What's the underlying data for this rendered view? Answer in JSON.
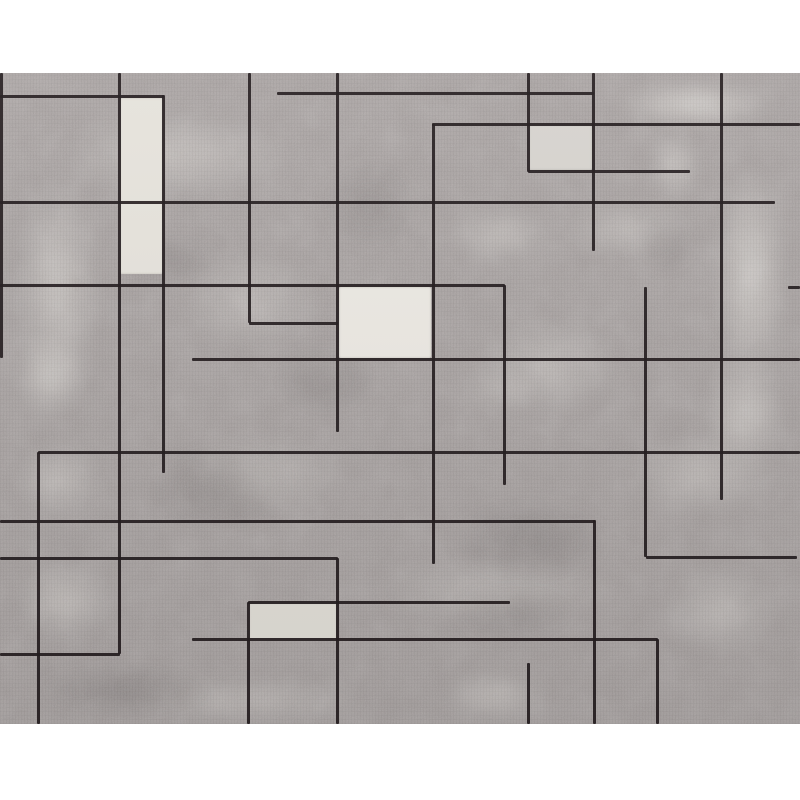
{
  "canvas": {
    "width": 800,
    "height": 800,
    "background": "#ffffff"
  },
  "rug": {
    "left": 0,
    "top": 73,
    "width": 800,
    "height": 651,
    "base_color": "#a39d9c",
    "light_mottle_color": "#e2dfda",
    "dark_mottle_color": "#4a4444",
    "cream_color": "#eae7e0",
    "line_color": "#241d1f",
    "line_thickness": 3,
    "vlines": [
      {
        "x": 1,
        "y1": 0,
        "y2": 285
      },
      {
        "x": 119,
        "y1": 0,
        "y2": 581
      },
      {
        "x": 163,
        "y1": 22,
        "y2": 400
      },
      {
        "x": 249,
        "y1": 0,
        "y2": 250
      },
      {
        "x": 337,
        "y1": 0,
        "y2": 359
      },
      {
        "x": 337,
        "y1": 485,
        "y2": 651
      },
      {
        "x": 38,
        "y1": 379,
        "y2": 651
      },
      {
        "x": 248,
        "y1": 529,
        "y2": 651
      },
      {
        "x": 528,
        "y1": 0,
        "y2": 99
      },
      {
        "x": 593,
        "y1": 0,
        "y2": 178
      },
      {
        "x": 594,
        "y1": 447,
        "y2": 651
      },
      {
        "x": 433,
        "y1": 51,
        "y2": 491
      },
      {
        "x": 504,
        "y1": 212,
        "y2": 412
      },
      {
        "x": 645,
        "y1": 214,
        "y2": 484
      },
      {
        "x": 721,
        "y1": 0,
        "y2": 427
      },
      {
        "x": 528,
        "y1": 590,
        "y2": 651
      },
      {
        "x": 657,
        "y1": 566,
        "y2": 651
      }
    ],
    "hlines": [
      {
        "y": 23,
        "x1": 0,
        "x2": 164
      },
      {
        "y": 20,
        "x1": 277,
        "x2": 594
      },
      {
        "y": 51,
        "x1": 432,
        "x2": 800
      },
      {
        "y": 98,
        "x1": 528,
        "x2": 690
      },
      {
        "y": 129,
        "x1": 0,
        "x2": 775
      },
      {
        "y": 212,
        "x1": 0,
        "x2": 505
      },
      {
        "y": 214,
        "x1": 788,
        "x2": 800
      },
      {
        "y": 250,
        "x1": 249,
        "x2": 338
      },
      {
        "y": 286,
        "x1": 192,
        "x2": 800
      },
      {
        "y": 379,
        "x1": 38,
        "x2": 800
      },
      {
        "y": 448,
        "x1": 0,
        "x2": 595
      },
      {
        "y": 485,
        "x1": 0,
        "x2": 338
      },
      {
        "y": 484,
        "x1": 646,
        "x2": 797
      },
      {
        "y": 529,
        "x1": 248,
        "x2": 510
      },
      {
        "y": 566,
        "x1": 192,
        "x2": 658
      },
      {
        "y": 581,
        "x1": 0,
        "x2": 120
      }
    ],
    "patches": [
      {
        "x": 120,
        "y": 25,
        "w": 43,
        "h": 176,
        "color": "#e6e3dc"
      },
      {
        "x": 339,
        "y": 214,
        "w": 92,
        "h": 71,
        "color": "#ece9e3"
      },
      {
        "x": 249,
        "y": 530,
        "w": 88,
        "h": 38,
        "color": "#e0ddd6"
      },
      {
        "x": 529,
        "y": 52,
        "w": 63,
        "h": 45,
        "color": "#d7d4cf"
      }
    ],
    "light_blobs": [
      {
        "x": 0,
        "y": 67,
        "w": 115,
        "h": 290,
        "o": 0.5
      },
      {
        "x": 0,
        "y": 247,
        "w": 100,
        "h": 110,
        "o": 0.55
      },
      {
        "x": 20,
        "y": 22,
        "w": 310,
        "h": 120,
        "o": 0.4
      },
      {
        "x": 150,
        "y": 157,
        "w": 200,
        "h": 140,
        "o": 0.3
      },
      {
        "x": 590,
        "y": 0,
        "w": 210,
        "h": 62,
        "o": 0.65
      },
      {
        "x": 640,
        "y": 47,
        "w": 70,
        "h": 90,
        "o": 0.45
      },
      {
        "x": 700,
        "y": 52,
        "w": 100,
        "h": 300,
        "o": 0.6
      },
      {
        "x": 690,
        "y": 260,
        "w": 110,
        "h": 160,
        "o": 0.5
      },
      {
        "x": 540,
        "y": 117,
        "w": 180,
        "h": 80,
        "o": 0.35
      },
      {
        "x": 430,
        "y": 127,
        "w": 140,
        "h": 70,
        "o": 0.4
      },
      {
        "x": 450,
        "y": 227,
        "w": 200,
        "h": 130,
        "o": 0.35
      },
      {
        "x": 600,
        "y": 347,
        "w": 200,
        "h": 110,
        "o": 0.35
      },
      {
        "x": 0,
        "y": 357,
        "w": 120,
        "h": 100,
        "o": 0.4
      },
      {
        "x": 150,
        "y": 347,
        "w": 220,
        "h": 110,
        "o": 0.35
      },
      {
        "x": 0,
        "y": 472,
        "w": 130,
        "h": 110,
        "o": 0.45
      },
      {
        "x": 330,
        "y": 472,
        "w": 330,
        "h": 90,
        "o": 0.3
      },
      {
        "x": 640,
        "y": 477,
        "w": 160,
        "h": 120,
        "o": 0.35
      },
      {
        "x": 90,
        "y": 597,
        "w": 320,
        "h": 60,
        "o": 0.35
      },
      {
        "x": 420,
        "y": 587,
        "w": 150,
        "h": 70,
        "o": 0.4
      },
      {
        "x": 440,
        "y": 287,
        "w": 120,
        "h": 60,
        "o": 0.25
      }
    ],
    "dark_blobs": [
      {
        "x": 120,
        "y": 357,
        "w": 200,
        "h": 120,
        "o": 0.22
      },
      {
        "x": 250,
        "y": 257,
        "w": 150,
        "h": 100,
        "o": 0.18
      },
      {
        "x": 420,
        "y": 407,
        "w": 220,
        "h": 120,
        "o": 0.22
      },
      {
        "x": 100,
        "y": 147,
        "w": 150,
        "h": 80,
        "o": 0.16
      },
      {
        "x": 0,
        "y": 582,
        "w": 250,
        "h": 70,
        "o": 0.22
      },
      {
        "x": 300,
        "y": 67,
        "w": 140,
        "h": 130,
        "o": 0.16
      },
      {
        "x": 430,
        "y": 500,
        "w": 170,
        "h": 80,
        "o": 0.18
      },
      {
        "x": 620,
        "y": 130,
        "w": 90,
        "h": 80,
        "o": 0.15
      }
    ]
  }
}
